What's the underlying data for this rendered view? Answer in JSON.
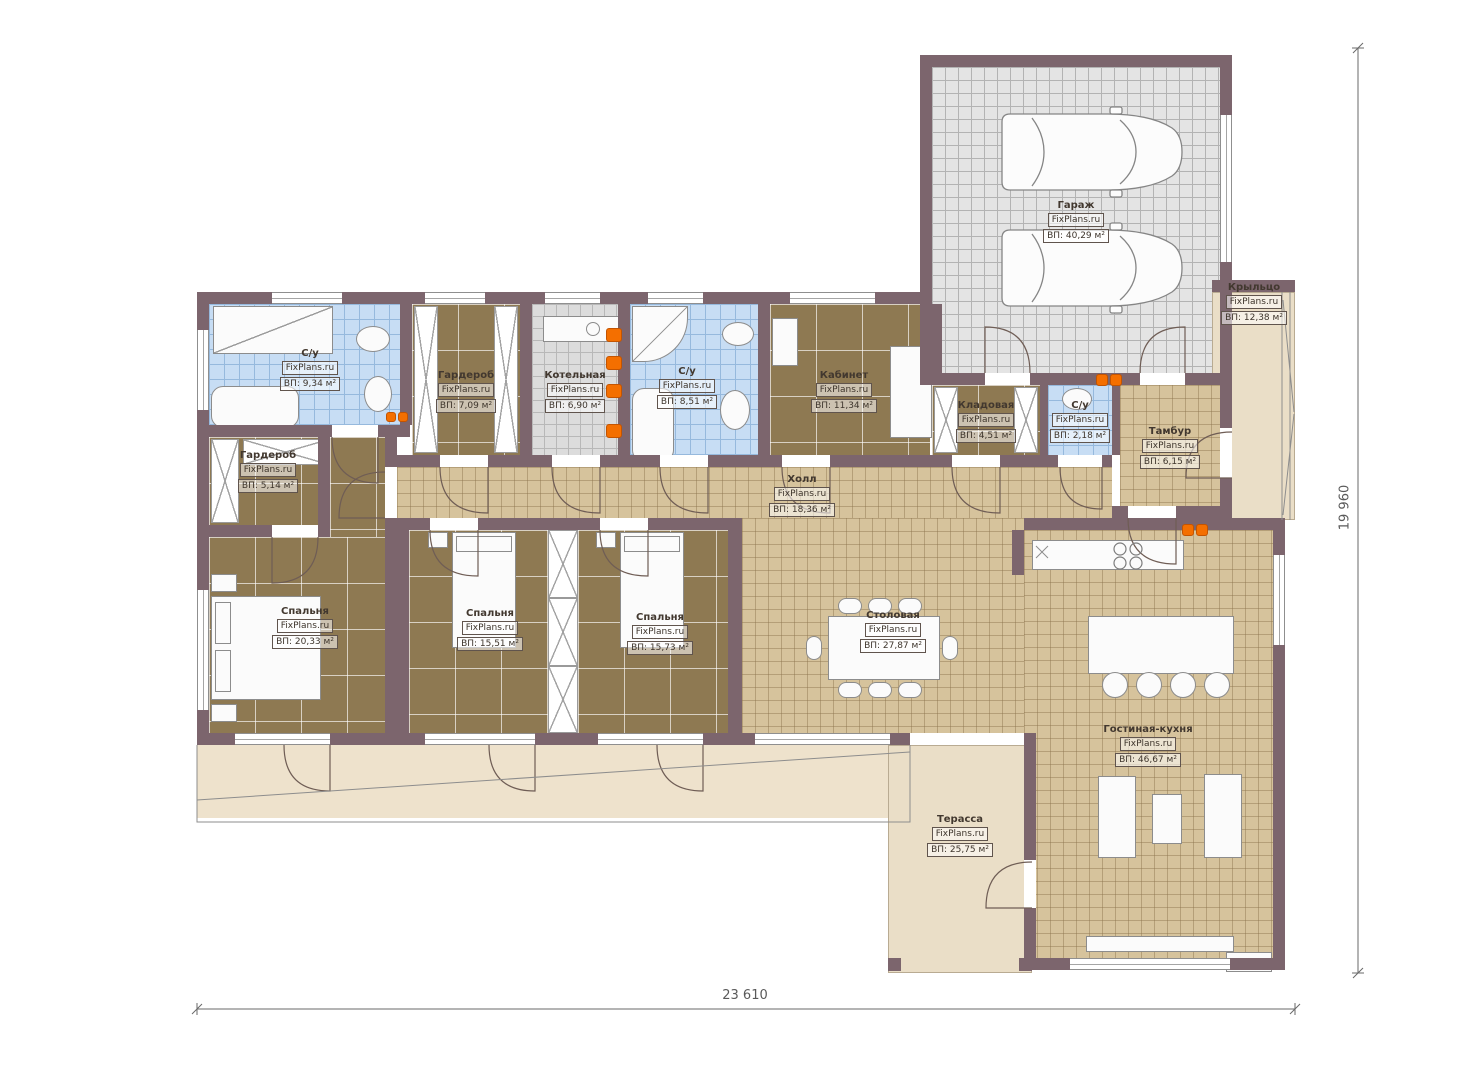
{
  "watermark": "FixPlans.ru",
  "dimensions": {
    "bottom": "23 610",
    "right": "19 960"
  },
  "rooms": [
    {
      "name": "С/у",
      "watermark": "FixPlans.ru",
      "area": "ВП: 9,34 м²"
    },
    {
      "name": "Гардероб",
      "watermark": "FixPlans.ru",
      "area": "ВП: 7,09 м²"
    },
    {
      "name": "Котельная",
      "watermark": "FixPlans.ru",
      "area": "ВП: 6,90 м²"
    },
    {
      "name": "С/у",
      "watermark": "FixPlans.ru",
      "area": "ВП: 8,51 м²"
    },
    {
      "name": "Кабинет",
      "watermark": "FixPlans.ru",
      "area": "ВП: 11,34 м²"
    },
    {
      "name": "Кладовая",
      "watermark": "FixPlans.ru",
      "area": "ВП: 4,51 м²"
    },
    {
      "name": "С/у",
      "watermark": "FixPlans.ru",
      "area": "ВП: 2,18 м²"
    },
    {
      "name": "Тамбур",
      "watermark": "FixPlans.ru",
      "area": "ВП: 6,15 м²"
    },
    {
      "name": "Гардероб",
      "watermark": "FixPlans.ru",
      "area": "ВП: 5,14 м²"
    },
    {
      "name": "Холл",
      "watermark": "FixPlans.ru",
      "area": "ВП: 18,36 м²"
    },
    {
      "name": "Спальня",
      "watermark": "FixPlans.ru",
      "area": "ВП: 20,33 м²"
    },
    {
      "name": "Спальня",
      "watermark": "FixPlans.ru",
      "area": "ВП: 15,51 м²"
    },
    {
      "name": "Спальня",
      "watermark": "FixPlans.ru",
      "area": "ВП: 15,73 м²"
    },
    {
      "name": "Столовая",
      "watermark": "FixPlans.ru",
      "area": "ВП: 27,87 м²"
    },
    {
      "name": "Гостиная-кухня",
      "watermark": "FixPlans.ru",
      "area": "ВП: 46,67 м²"
    },
    {
      "name": "Терасса",
      "watermark": "FixPlans.ru",
      "area": "ВП: 25,75 м²"
    },
    {
      "name": "Гараж",
      "watermark": "FixPlans.ru",
      "area": "ВП: 40,29 м²"
    },
    {
      "name": "Крыльцо",
      "watermark": "FixPlans.ru",
      "area": "ВП: 12,38 м²"
    }
  ]
}
